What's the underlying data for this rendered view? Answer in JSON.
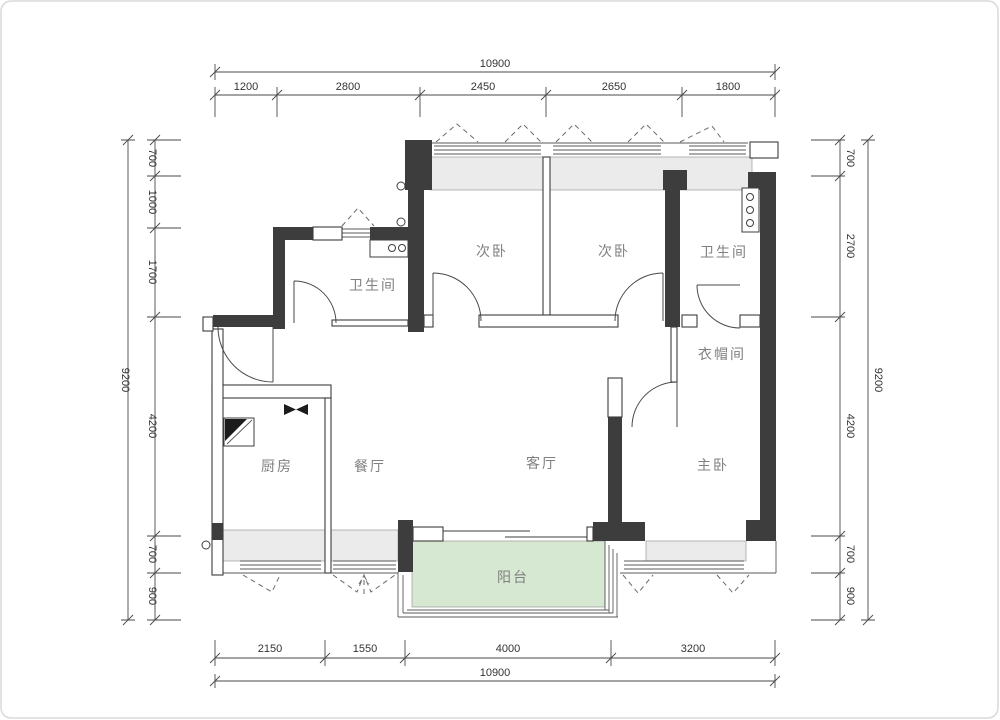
{
  "title": "apartment-floor-plan",
  "colors": {
    "wall": "#3d3d3d",
    "sill_fill": "#ebebeb",
    "balcony_fill": "#d6e7d2",
    "line": "#4a4a4a",
    "dim_text": "#333333",
    "room_text": "#808080",
    "background": "#ffffff"
  },
  "rooms": {
    "bath1": "卫生间",
    "bed1": "次卧",
    "bed2": "次卧",
    "bath2": "卫生间",
    "cloak": "衣帽间",
    "kitchen": "厨房",
    "dining": "餐厅",
    "living": "客厅",
    "master": "主卧",
    "balcony": "阳台"
  },
  "dims": {
    "top": {
      "total": "10900",
      "segments": [
        "1200",
        "2800",
        "2450",
        "2650",
        "1800"
      ]
    },
    "bottom": {
      "total": "10900",
      "segments": [
        "2150",
        "1550",
        "4000",
        "3200"
      ]
    },
    "left": {
      "total": "9200",
      "segments": [
        "700",
        "1000",
        "1700",
        "4200",
        "700",
        "900"
      ]
    },
    "right": {
      "total": "9200",
      "segments": [
        "700",
        "2700",
        "4200",
        "700",
        "900"
      ]
    }
  }
}
